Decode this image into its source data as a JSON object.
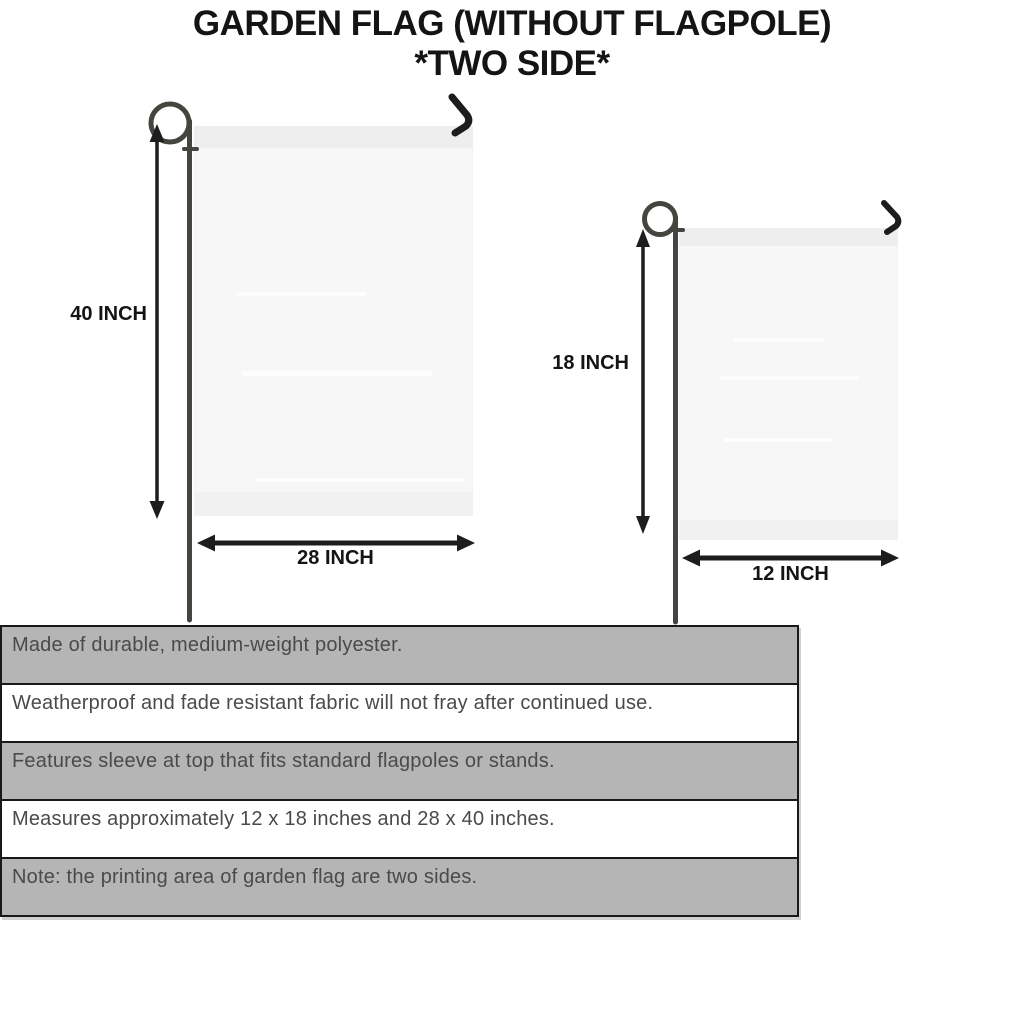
{
  "title": {
    "line1": "GARDEN FLAG (WITHOUT FLAGPOLE)",
    "line2": "*TWO SIDE*"
  },
  "flags": {
    "large": {
      "height_label": "40 INCH",
      "width_label": "28 INCH"
    },
    "small": {
      "height_label": "18 INCH",
      "width_label": "12 INCH"
    }
  },
  "features": [
    "Made of durable, medium-weight polyester.",
    "Weatherproof and fade resistant fabric will not fray after continued use.",
    "Features sleeve at top that fits standard flagpoles or stands.",
    "Measures approximately 12 x 18 inches and 28 x 40 inches.",
    "Note: the printing area of garden flag are two sides."
  ],
  "colors": {
    "ink": "#141414",
    "arrow": "#1d1d1d",
    "pole": "#45453f",
    "flag": "#f7f7f8",
    "row-gray": "#b5b5b5",
    "row-text": "#4a4a4b",
    "table-border": "#191919"
  }
}
